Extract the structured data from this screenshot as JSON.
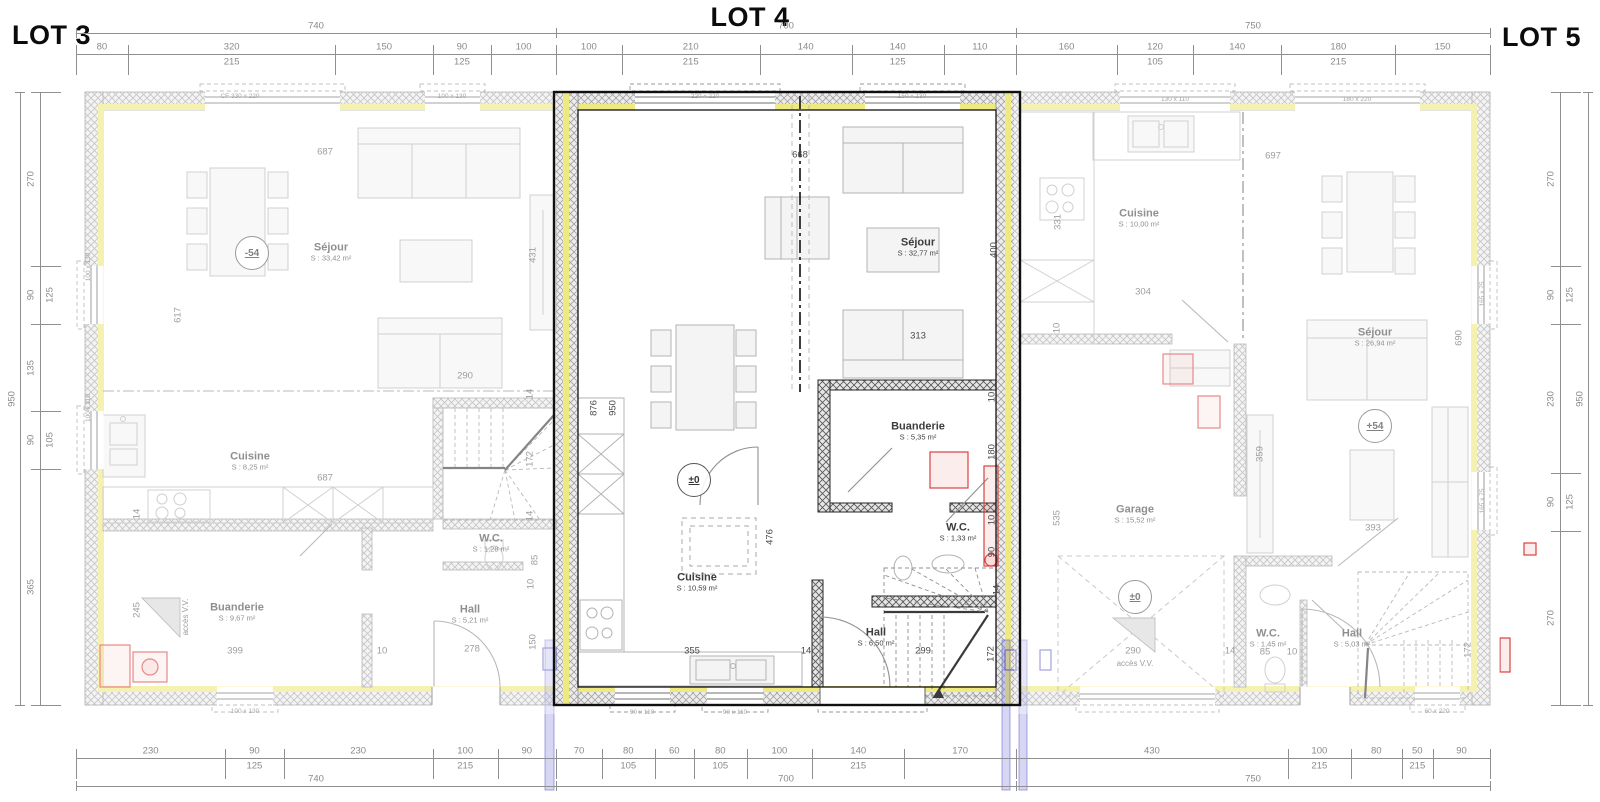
{
  "titles": {
    "lot3": "LOT 3",
    "lot4": "LOT 4",
    "lot5": "LOT 5"
  },
  "colors": {
    "insulation": "#efe982",
    "lot4_outline": "#101010",
    "red_fixture": "#d84040",
    "blue_pipe": "#7070d8",
    "wall_hatch": "#8a8a8a"
  },
  "dim_strips": [
    {
      "dir": "h",
      "x0": 76,
      "x1": 556,
      "y": 54,
      "tY": 33,
      "total": "740",
      "segs": [
        {
          "v": "80"
        },
        {
          "v": "320",
          "v2": "215"
        },
        {
          "v": "150"
        },
        {
          "v": "90",
          "v2": "125"
        },
        {
          "v": "100"
        }
      ]
    },
    {
      "dir": "h",
      "x0": 556,
      "x1": 1016,
      "y": 54,
      "tY": 33,
      "total": "700",
      "segs": [
        {
          "v": "100"
        },
        {
          "v": "210",
          "v2": "215"
        },
        {
          "v": "140"
        },
        {
          "v": "140",
          "v2": "125"
        },
        {
          "v": "110"
        }
      ]
    },
    {
      "dir": "h",
      "x0": 1016,
      "x1": 1490,
      "y": 54,
      "tY": 33,
      "total": "750",
      "segs": [
        {
          "v": "160"
        },
        {
          "v": "120",
          "v2": "105"
        },
        {
          "v": "140"
        },
        {
          "v": "180",
          "v2": "215"
        },
        {
          "v": "150"
        }
      ]
    },
    {
      "dir": "h",
      "x0": 76,
      "x1": 556,
      "y": 758,
      "tY": 786,
      "total": "740",
      "segs": [
        {
          "v": "230"
        },
        {
          "v": "90",
          "v2": "125"
        },
        {
          "v": "230"
        },
        {
          "v": "100",
          "v2": "215"
        },
        {
          "v": "90"
        }
      ]
    },
    {
      "dir": "h",
      "x0": 556,
      "x1": 1016,
      "y": 758,
      "tY": 786,
      "total": "700",
      "segs": [
        {
          "v": "70"
        },
        {
          "v": "80",
          "v2": "105"
        },
        {
          "v": "60"
        },
        {
          "v": "80",
          "v2": "105"
        },
        {
          "v": "100"
        },
        {
          "v": "140",
          "v2": "215"
        },
        {
          "v": "170"
        }
      ]
    },
    {
      "dir": "h",
      "x0": 1016,
      "x1": 1490,
      "y": 758,
      "tY": 786,
      "total": "750",
      "segs": [
        {
          "v": "430"
        },
        {
          "v": "100",
          "v2": "215"
        },
        {
          "v": "80"
        },
        {
          "v": "50",
          "v2": "215"
        },
        {
          "v": "90"
        }
      ]
    },
    {
      "dir": "v",
      "y0": 92,
      "y1": 705,
      "x": 40,
      "tX": 20,
      "total": "950",
      "segs": [
        {
          "v": "270"
        },
        {
          "v": "90",
          "v2": "125"
        },
        {
          "v": "135"
        },
        {
          "v": "90",
          "v2": "105"
        },
        {
          "v": "365"
        }
      ]
    },
    {
      "dir": "v",
      "y0": 92,
      "y1": 705,
      "x": 1560,
      "tX": 1588,
      "total": "950",
      "segs": [
        {
          "v": "270"
        },
        {
          "v": "90",
          "v2": "125"
        },
        {
          "v": "230"
        },
        {
          "v": "90",
          "v2": "125"
        },
        {
          "v": "270"
        }
      ]
    }
  ],
  "rooms": [
    {
      "name": "Séjour",
      "area": "S : 33,42 m²",
      "x": 331,
      "y": 252,
      "cls": "faded"
    },
    {
      "name": "Cuisine",
      "area": "S : 8,25 m²",
      "x": 250,
      "y": 461,
      "cls": "faded"
    },
    {
      "name": "Buanderie",
      "area": "S : 9,67 m²",
      "x": 237,
      "y": 612,
      "cls": "faded"
    },
    {
      "name": "W.C.",
      "area": "S : 1,28 m²",
      "x": 491,
      "y": 543,
      "cls": "faded"
    },
    {
      "name": "Hall",
      "area": "S : 5,21 m²",
      "x": 470,
      "y": 614,
      "cls": "faded"
    },
    {
      "name": "Séjour",
      "area": "S : 32,77 m²",
      "x": 918,
      "y": 247,
      "cls": "strong"
    },
    {
      "name": "Cuisine",
      "area": "S : 10,59 m²",
      "x": 697,
      "y": 582,
      "cls": "strong"
    },
    {
      "name": "Buanderie",
      "area": "S : 5,35 m²",
      "x": 918,
      "y": 431,
      "cls": "strong"
    },
    {
      "name": "W.C.",
      "area": "S : 1,33 m²",
      "x": 958,
      "y": 532,
      "cls": "strong"
    },
    {
      "name": "Hall",
      "area": "S : 6,50 m²",
      "x": 876,
      "y": 637,
      "cls": "strong"
    },
    {
      "name": "Cuisine",
      "area": "S : 10,00 m²",
      "x": 1139,
      "y": 218,
      "cls": "faded"
    },
    {
      "name": "Séjour",
      "area": "S : 26,94 m²",
      "x": 1375,
      "y": 337,
      "cls": "faded"
    },
    {
      "name": "Garage",
      "area": "S : 15,52 m²",
      "x": 1135,
      "y": 514,
      "cls": "faded"
    },
    {
      "name": "W.C.",
      "area": "S : 1,45 m²",
      "x": 1268,
      "y": 638,
      "cls": "faded"
    },
    {
      "name": "Hall",
      "area": "S : 5,03 m²",
      "x": 1352,
      "y": 638,
      "cls": "faded"
    }
  ],
  "levels": [
    {
      "t": "-54",
      "x": 252,
      "y": 253,
      "cls": "faded"
    },
    {
      "t": "±0",
      "x": 694,
      "y": 480,
      "cls": "strong"
    },
    {
      "t": "±0",
      "x": 1135,
      "y": 597,
      "cls": "faded"
    },
    {
      "t": "+54",
      "x": 1375,
      "y": 426,
      "cls": "faded"
    }
  ],
  "dims": [
    {
      "t": "687",
      "x": 325,
      "y": 152,
      "cls": "faded"
    },
    {
      "t": "617",
      "x": 178,
      "y": 315,
      "rot": 1,
      "cls": "faded"
    },
    {
      "t": "431",
      "x": 533,
      "y": 255,
      "rot": 1,
      "cls": "faded"
    },
    {
      "t": "290",
      "x": 465,
      "y": 376,
      "cls": "faded"
    },
    {
      "t": "687",
      "x": 325,
      "y": 478,
      "cls": "faded"
    },
    {
      "t": "14",
      "x": 137,
      "y": 514,
      "rot": 1,
      "cls": "faded"
    },
    {
      "t": "14",
      "x": 530,
      "y": 394,
      "rot": 1,
      "cls": "faded"
    },
    {
      "t": "172",
      "x": 530,
      "y": 459,
      "rot": 1,
      "cls": "faded"
    },
    {
      "t": "14",
      "x": 530,
      "y": 516,
      "rot": 1,
      "cls": "faded"
    },
    {
      "t": "245",
      "x": 137,
      "y": 610,
      "rot": 1,
      "cls": "faded"
    },
    {
      "t": "399",
      "x": 235,
      "y": 651,
      "cls": "faded"
    },
    {
      "t": "10",
      "x": 382,
      "y": 651,
      "cls": "faded"
    },
    {
      "t": "278",
      "x": 472,
      "y": 649,
      "cls": "faded"
    },
    {
      "t": "150",
      "x": 533,
      "y": 642,
      "rot": 1,
      "cls": "faded"
    },
    {
      "t": "85",
      "x": 535,
      "y": 560,
      "rot": 1,
      "cls": "faded"
    },
    {
      "t": "10",
      "x": 531,
      "y": 584,
      "rot": 1,
      "cls": "faded"
    },
    {
      "t": "668",
      "x": 800,
      "y": 155,
      "cls": "strong"
    },
    {
      "t": "400",
      "x": 994,
      "y": 250,
      "rot": 1,
      "cls": "strong"
    },
    {
      "t": "313",
      "x": 918,
      "y": 336,
      "cls": "strong"
    },
    {
      "t": "876",
      "x": 594,
      "y": 408,
      "rot": 1,
      "cls": "strong"
    },
    {
      "t": "950",
      "x": 613,
      "y": 408,
      "rot": 1,
      "cls": "strong"
    },
    {
      "t": "476",
      "x": 770,
      "y": 537,
      "rot": 1,
      "cls": "strong"
    },
    {
      "t": "355",
      "x": 692,
      "y": 651,
      "cls": "strong"
    },
    {
      "t": "14",
      "x": 806,
      "y": 651,
      "cls": "strong"
    },
    {
      "t": "10",
      "x": 992,
      "y": 397,
      "rot": 1,
      "cls": "strong"
    },
    {
      "t": "180",
      "x": 992,
      "y": 452,
      "rot": 1,
      "cls": "strong"
    },
    {
      "t": "10",
      "x": 992,
      "y": 520,
      "rot": 1,
      "cls": "strong"
    },
    {
      "t": "90",
      "x": 992,
      "y": 552,
      "rot": 1,
      "cls": "strong"
    },
    {
      "t": "299",
      "x": 923,
      "y": 651,
      "cls": "strong"
    },
    {
      "t": "172",
      "x": 991,
      "y": 654,
      "rot": 1,
      "cls": "strong"
    },
    {
      "t": "14",
      "x": 997,
      "y": 590,
      "rot": 1,
      "cls": "strong"
    },
    {
      "t": "697",
      "x": 1273,
      "y": 156,
      "cls": "faded"
    },
    {
      "t": "331",
      "x": 1058,
      "y": 222,
      "rot": 1,
      "cls": "faded"
    },
    {
      "t": "304",
      "x": 1143,
      "y": 292,
      "cls": "faded"
    },
    {
      "t": "10",
      "x": 1057,
      "y": 328,
      "rot": 1,
      "cls": "faded"
    },
    {
      "t": "690",
      "x": 1459,
      "y": 338,
      "rot": 1,
      "cls": "faded"
    },
    {
      "t": "359",
      "x": 1260,
      "y": 454,
      "rot": 1,
      "cls": "faded"
    },
    {
      "t": "393",
      "x": 1373,
      "y": 528,
      "cls": "faded"
    },
    {
      "t": "535",
      "x": 1057,
      "y": 518,
      "rot": 1,
      "cls": "faded"
    },
    {
      "t": "290",
      "x": 1133,
      "y": 651,
      "cls": "faded"
    },
    {
      "t": "14",
      "x": 1230,
      "y": 651,
      "cls": "faded"
    },
    {
      "t": "85",
      "x": 1265,
      "y": 652,
      "cls": "faded"
    },
    {
      "t": "10",
      "x": 1292,
      "y": 652,
      "cls": "faded"
    },
    {
      "t": "172",
      "x": 1468,
      "y": 650,
      "rot": 1,
      "cls": "faded"
    }
  ],
  "window_tags": [
    {
      "t": "CF  330 x 220",
      "x": 240,
      "y": 97
    },
    {
      "t": "100 x 130",
      "x": 452,
      "y": 97
    },
    {
      "t": "220 x 220",
      "x": 705,
      "y": 97
    },
    {
      "t": "150 x 130",
      "x": 912,
      "y": 97
    },
    {
      "t": "130 x 110",
      "x": 1175,
      "y": 100
    },
    {
      "t": "180 x 220",
      "x": 1357,
      "y": 100
    },
    {
      "t": "100 x 130",
      "x": 245,
      "y": 712
    },
    {
      "t": "90 x 110",
      "x": 642,
      "y": 713
    },
    {
      "t": "90 x 110",
      "x": 735,
      "y": 713
    },
    {
      "t": "60 x 220",
      "x": 1437,
      "y": 712
    },
    {
      "t": "100 x 130",
      "x": 89,
      "y": 267,
      "rot": 1
    },
    {
      "t": "100 x 110",
      "x": 89,
      "y": 408,
      "rot": 1
    },
    {
      "t": "165 x 75",
      "x": 1483,
      "y": 294,
      "rot": 1
    },
    {
      "t": "165 x 75",
      "x": 1483,
      "y": 501,
      "rot": 1
    }
  ],
  "notes": [
    {
      "t": "accès V.V.",
      "x": 186,
      "y": 617,
      "rot": 1
    },
    {
      "t": "accès V.V.",
      "x": 1135,
      "y": 664
    }
  ]
}
